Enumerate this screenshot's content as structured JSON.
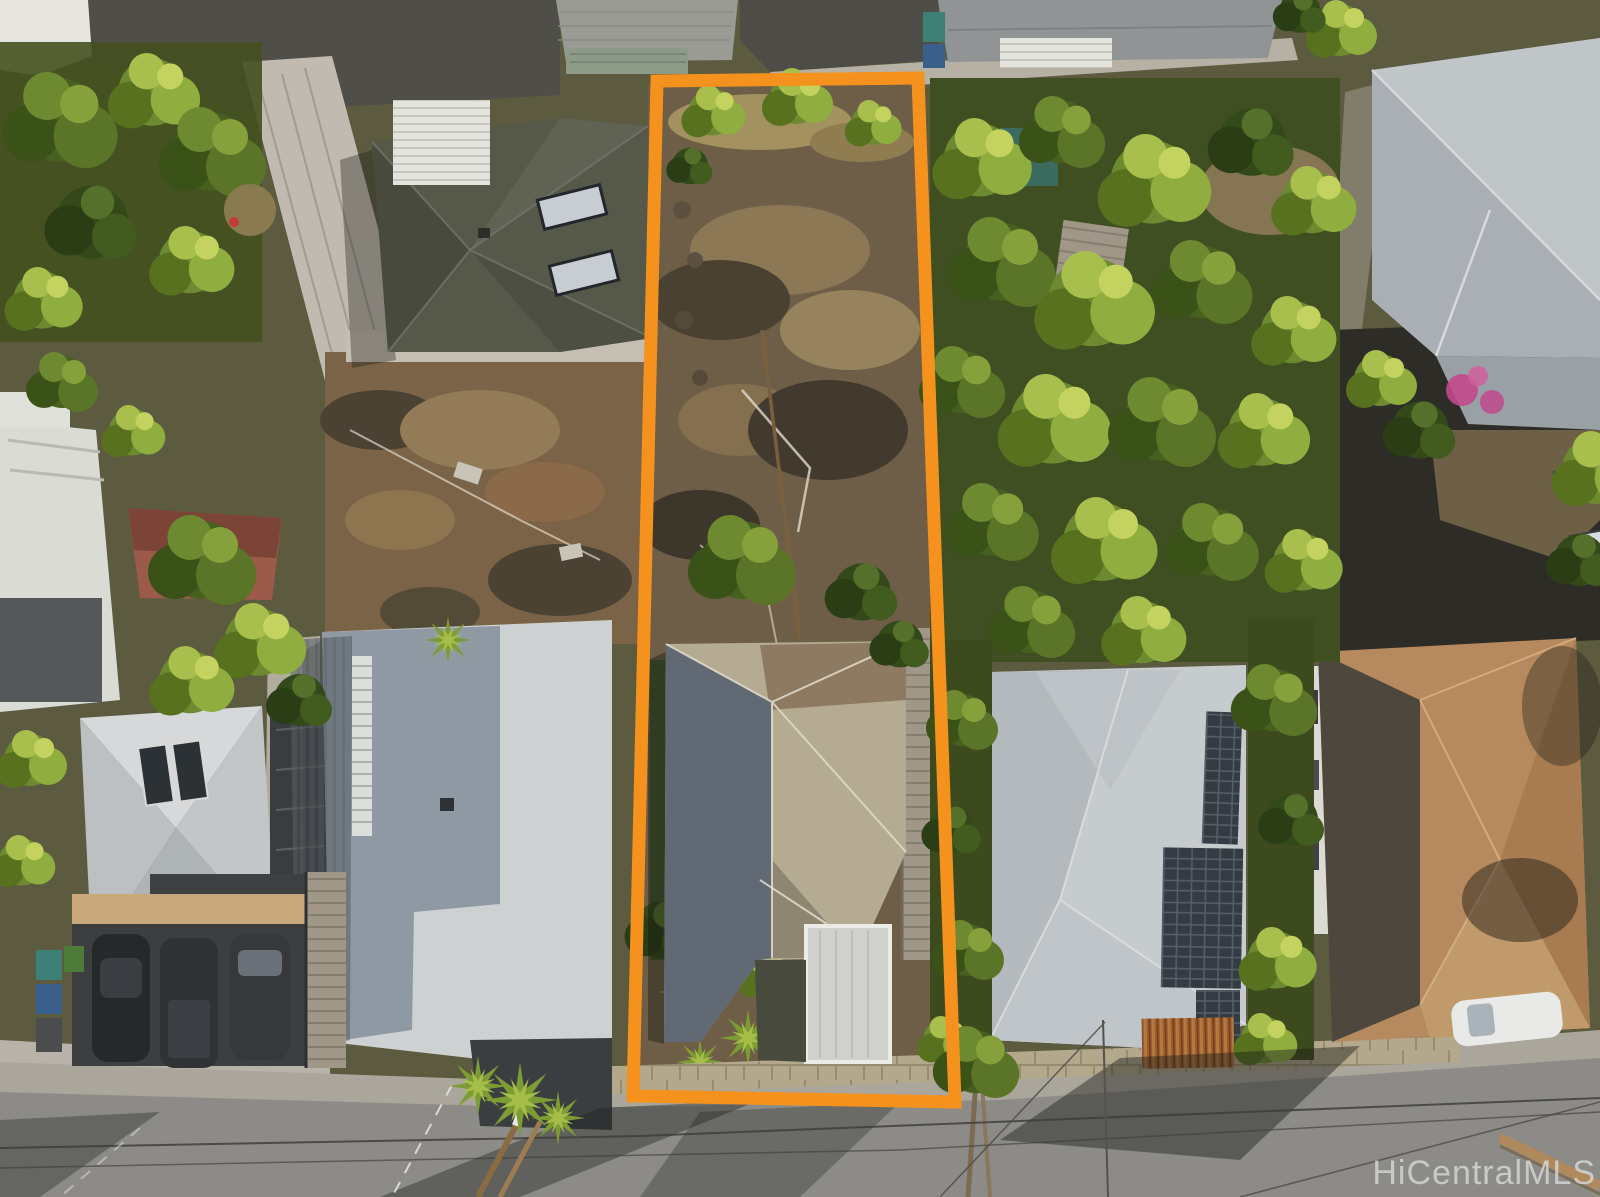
{
  "scene": {
    "type": "aerial-photograph",
    "description": "Bird's-eye drone photo of a hillside residential block; a long narrow parcel containing a sloped vacant yard and a gray hip-roof house is outlined in orange; neighboring homes with gray, dark and brown roofs, solar panels, mature trees, a dirt lot, parked cars and a street with long shadows and utility wires surround it.",
    "watermark": {
      "text": "HiCentralMLS",
      "color": "#d9d9d9"
    }
  },
  "annotation": {
    "boundary_color": "#F5921E",
    "boundary_width_px": 13
  }
}
